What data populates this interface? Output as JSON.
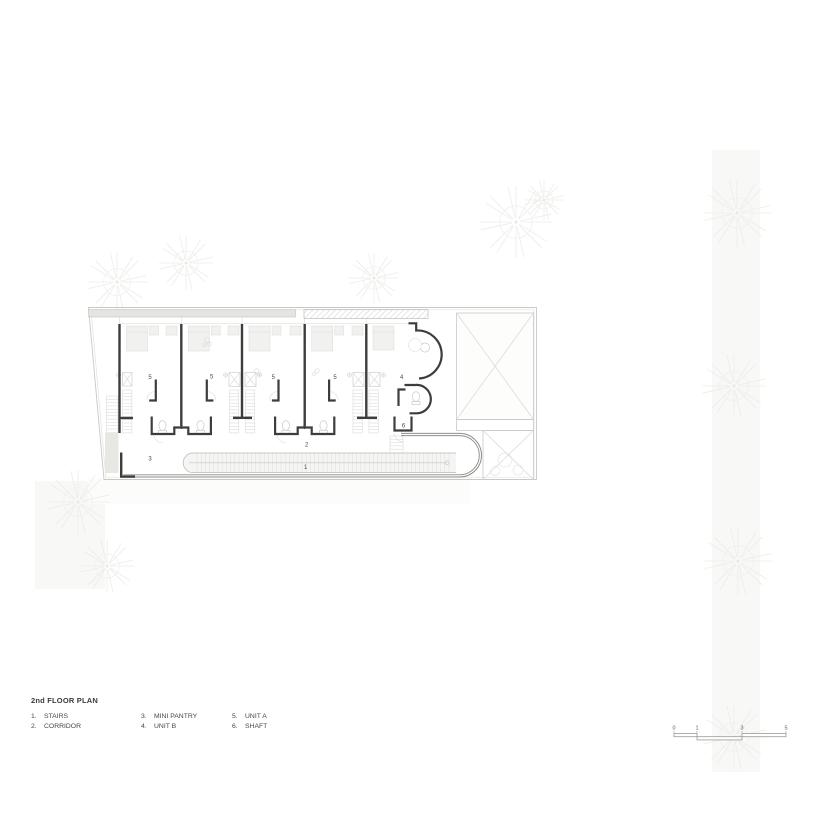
{
  "title_block": {
    "title": "2nd FLOOR PLAN"
  },
  "legend": {
    "items": [
      {
        "num": "1.",
        "label": "STAIRS"
      },
      {
        "num": "2.",
        "label": "CORRIDOR"
      },
      {
        "num": "3.",
        "label": "MINI PANTRY"
      },
      {
        "num": "4.",
        "label": "UNIT B"
      },
      {
        "num": "5.",
        "label": "UNIT A"
      },
      {
        "num": "6.",
        "label": "SHAFT"
      }
    ]
  },
  "scale_bar": {
    "labels": [
      {
        "text": "0",
        "x": 6
      },
      {
        "text": "1",
        "x": 29
      },
      {
        "text": "3",
        "x": 74
      },
      {
        "text": "5",
        "x": 118
      }
    ]
  },
  "plan": {
    "room_labels": [
      {
        "text": "5",
        "x": 65,
        "y": 79
      },
      {
        "text": "5",
        "x": 126.7,
        "y": 78.5
      },
      {
        "text": "5",
        "x": 188.3,
        "y": 79
      },
      {
        "text": "5",
        "x": 250,
        "y": 79
      },
      {
        "text": "4",
        "x": 316.7,
        "y": 79
      },
      {
        "text": "6",
        "x": 96.5,
        "y": 129
      },
      {
        "text": "6",
        "x": 219.5,
        "y": 129
      },
      {
        "text": "6",
        "x": 318.5,
        "y": 127.5
      },
      {
        "text": "2",
        "x": 221.7,
        "y": 146.5
      },
      {
        "text": "3",
        "x": 65,
        "y": 160.5
      },
      {
        "text": "1",
        "x": 220.7,
        "y": 169
      }
    ],
    "colors": {
      "wall": "#3d3d3d",
      "outline": "#c8c8c5",
      "light_line": "#d7d7d4",
      "band_fill": "#e4e4e1"
    }
  },
  "deco": {
    "trees": [
      {
        "x": 117,
        "y": 282,
        "r": 30
      },
      {
        "x": 186,
        "y": 263,
        "r": 27
      },
      {
        "x": 374,
        "y": 278,
        "r": 25
      },
      {
        "x": 516,
        "y": 222,
        "r": 36
      },
      {
        "x": 544,
        "y": 200,
        "r": 20
      },
      {
        "x": 78,
        "y": 502,
        "r": 32
      },
      {
        "x": 107,
        "y": 566,
        "r": 27
      },
      {
        "x": 737,
        "y": 213,
        "r": 34
      },
      {
        "x": 734,
        "y": 386,
        "r": 32
      },
      {
        "x": 738,
        "y": 561,
        "r": 34
      },
      {
        "x": 734,
        "y": 737,
        "r": 32
      }
    ]
  }
}
